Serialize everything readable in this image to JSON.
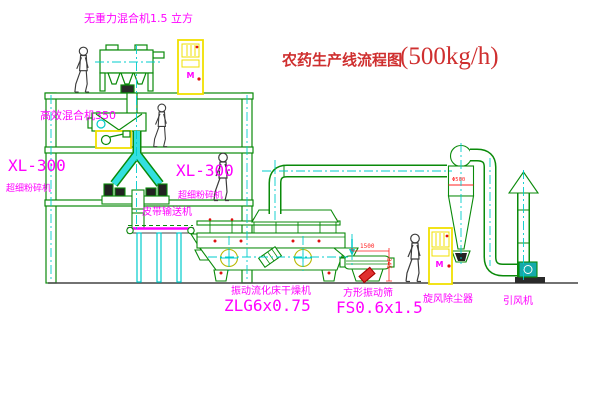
{
  "title": {
    "text": "农药生产线流程图",
    "capacity": "(500kg/h)"
  },
  "equipment_labels": {
    "zero_gravity_mixer": "无重力混合机1.5 立方",
    "high_efficiency_mixer": "高效混合机350",
    "mill_left_model": "XL-300",
    "mill_left_name": "超细粉碎机",
    "mill_right_model": "XL-300",
    "mill_right_name": "超细粉碎机",
    "belt_conveyor": "皮带输送机",
    "dryer_name": "振动流化床干燥机",
    "dryer_model": "ZLG6x0.75",
    "sieve_name": "方形振动筛",
    "sieve_model": "FS0.6x1.5",
    "cyclone": "旋风除尘器",
    "fan": "引风机"
  },
  "dimensions": {
    "sieve_length": "1500",
    "sieve_height": "345",
    "cyclone_diameter": "Φ500"
  },
  "control_panels": {
    "panel1_label": "M",
    "panel2_label": "M"
  },
  "colors": {
    "line_green": "#0a8a0a",
    "centerline_cyan": "#00cccc",
    "label_magenta": "#ff00ff",
    "title_red": "#cf2f2f",
    "dimension_red": "#ff2020",
    "panel_yellow": "#f0e000",
    "figure_dark": "#3c3c3c"
  }
}
